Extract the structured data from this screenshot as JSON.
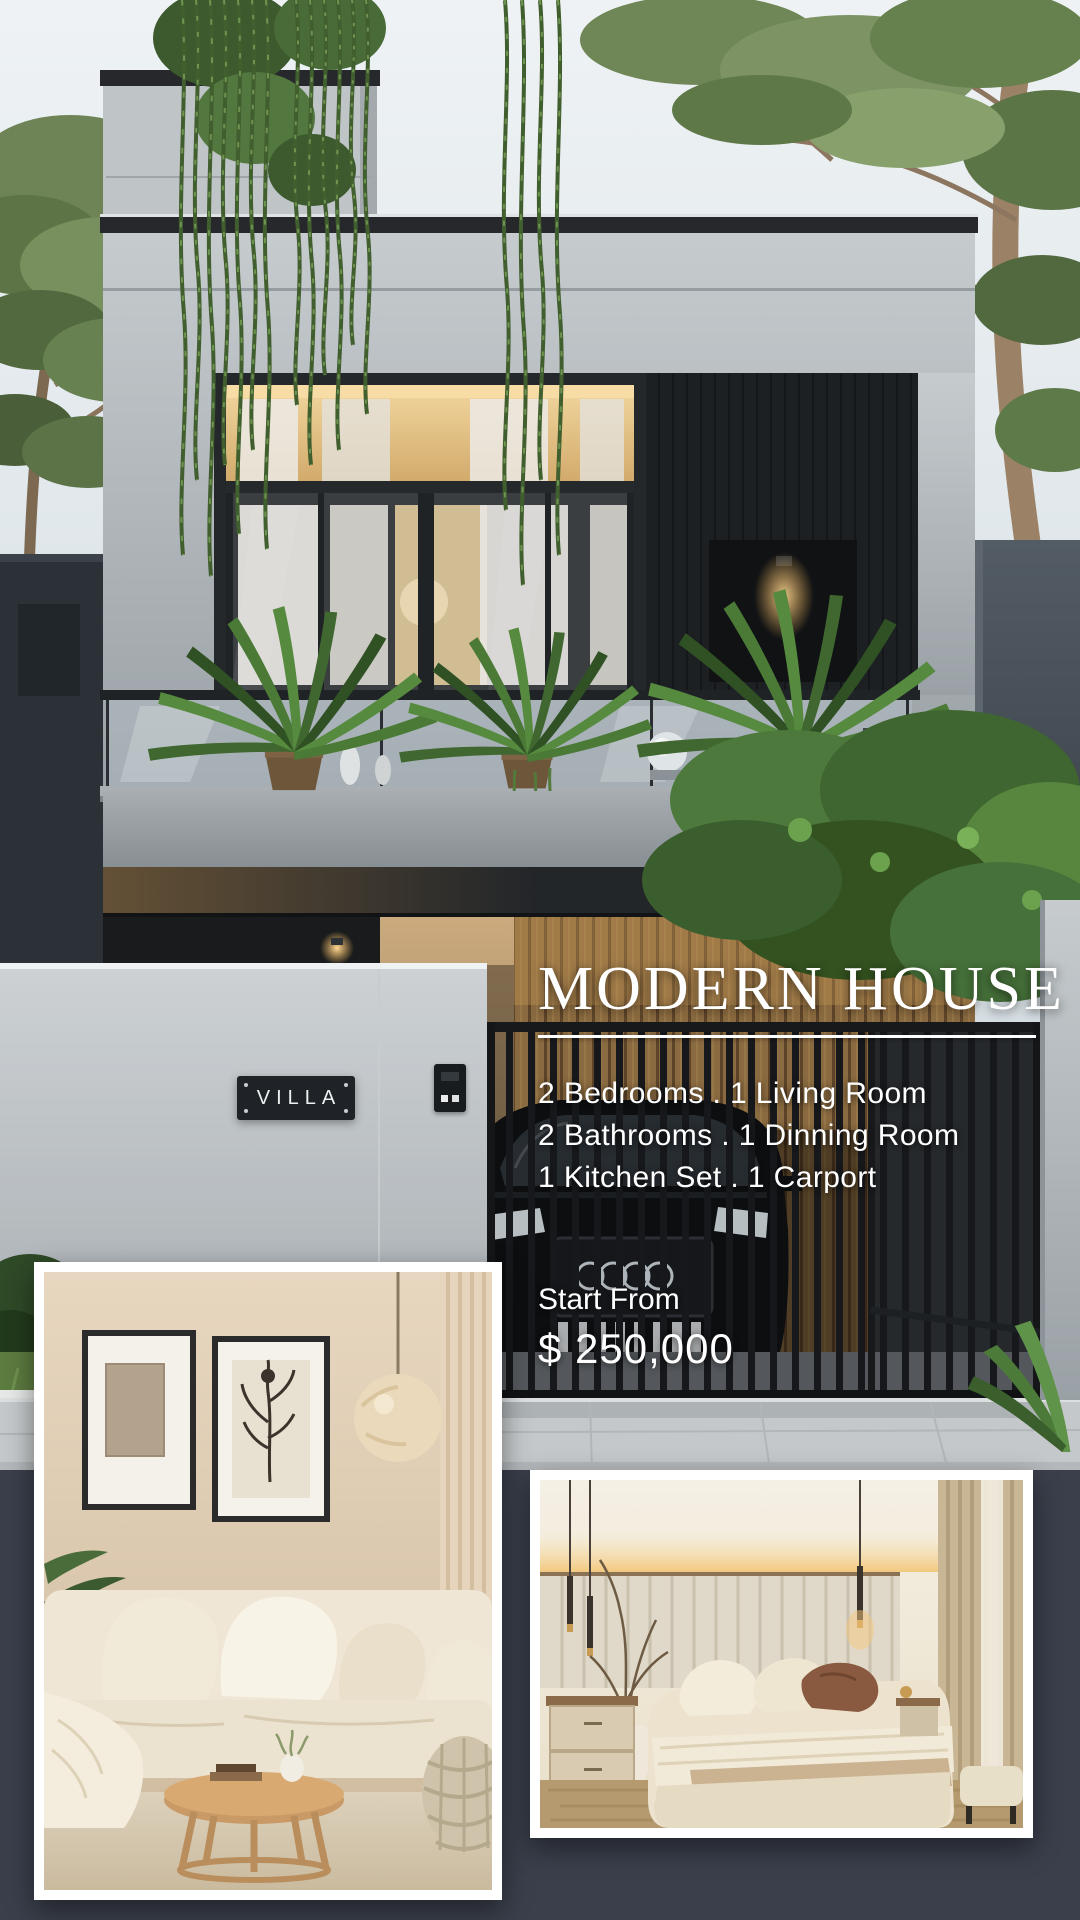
{
  "poster": {
    "title": "MODERN HOUSE",
    "features": [
      "2 Bedrooms . 1 Living Room",
      "2 Bathrooms . 1 Dinning Room",
      "1 Kitchen Set . 1 Carport"
    ],
    "price_label": "Start From",
    "price_value": "$ 250,000",
    "wall_plaque": "VILLA"
  },
  "photos": {
    "main": "modern-two-story-house-exterior-dusk",
    "inset_left": "beige-living-room-interior",
    "inset_right": "beige-bedroom-interior"
  },
  "colors": {
    "background_band": "#3a3f4b",
    "text": "#ffffff",
    "plaque_background": "#1f2327",
    "warm_glow": "#f0b35c",
    "inset_border": "#ffffff"
  }
}
